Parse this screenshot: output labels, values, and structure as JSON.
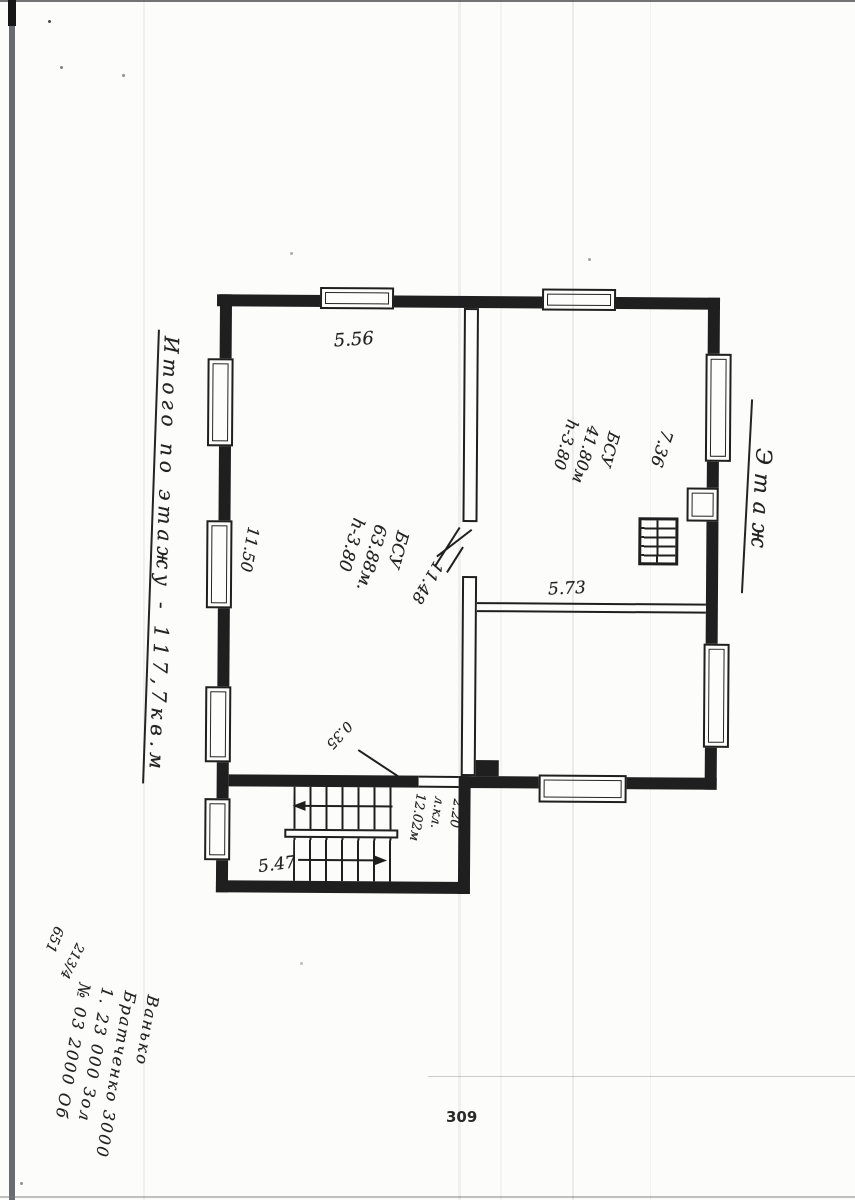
{
  "page": {
    "number": "309"
  },
  "margins": {
    "left_note": "Итого по этажу - 117,7кв.м",
    "right_title": "Этаж"
  },
  "rooms": {
    "right": {
      "name": "БСУ",
      "area": "41.80м",
      "height": "h-3.80"
    },
    "left": {
      "name": "БСУ",
      "area": "63.88м.",
      "height": "h-3.80"
    }
  },
  "dimensions": {
    "top": "5.56",
    "right_side": "7.36",
    "left_side": "11.50",
    "center": "11.48",
    "mid_wall": "5.73",
    "small_wall": "0.35",
    "stair_width": "5.47"
  },
  "stairwell": {
    "line1": "2.20",
    "line2": "л.кл.",
    "line3": "12.02м"
  },
  "notes": {
    "num_a": "651",
    "num_b": "213/4",
    "line1": "Ванько",
    "line2": "Братченко 3000",
    "line3": "1. 23 000 Зол",
    "line4": "№ 03 2000 Об"
  },
  "colors": {
    "ink": "#1f1f1f",
    "paper": "#fcfcfa"
  }
}
